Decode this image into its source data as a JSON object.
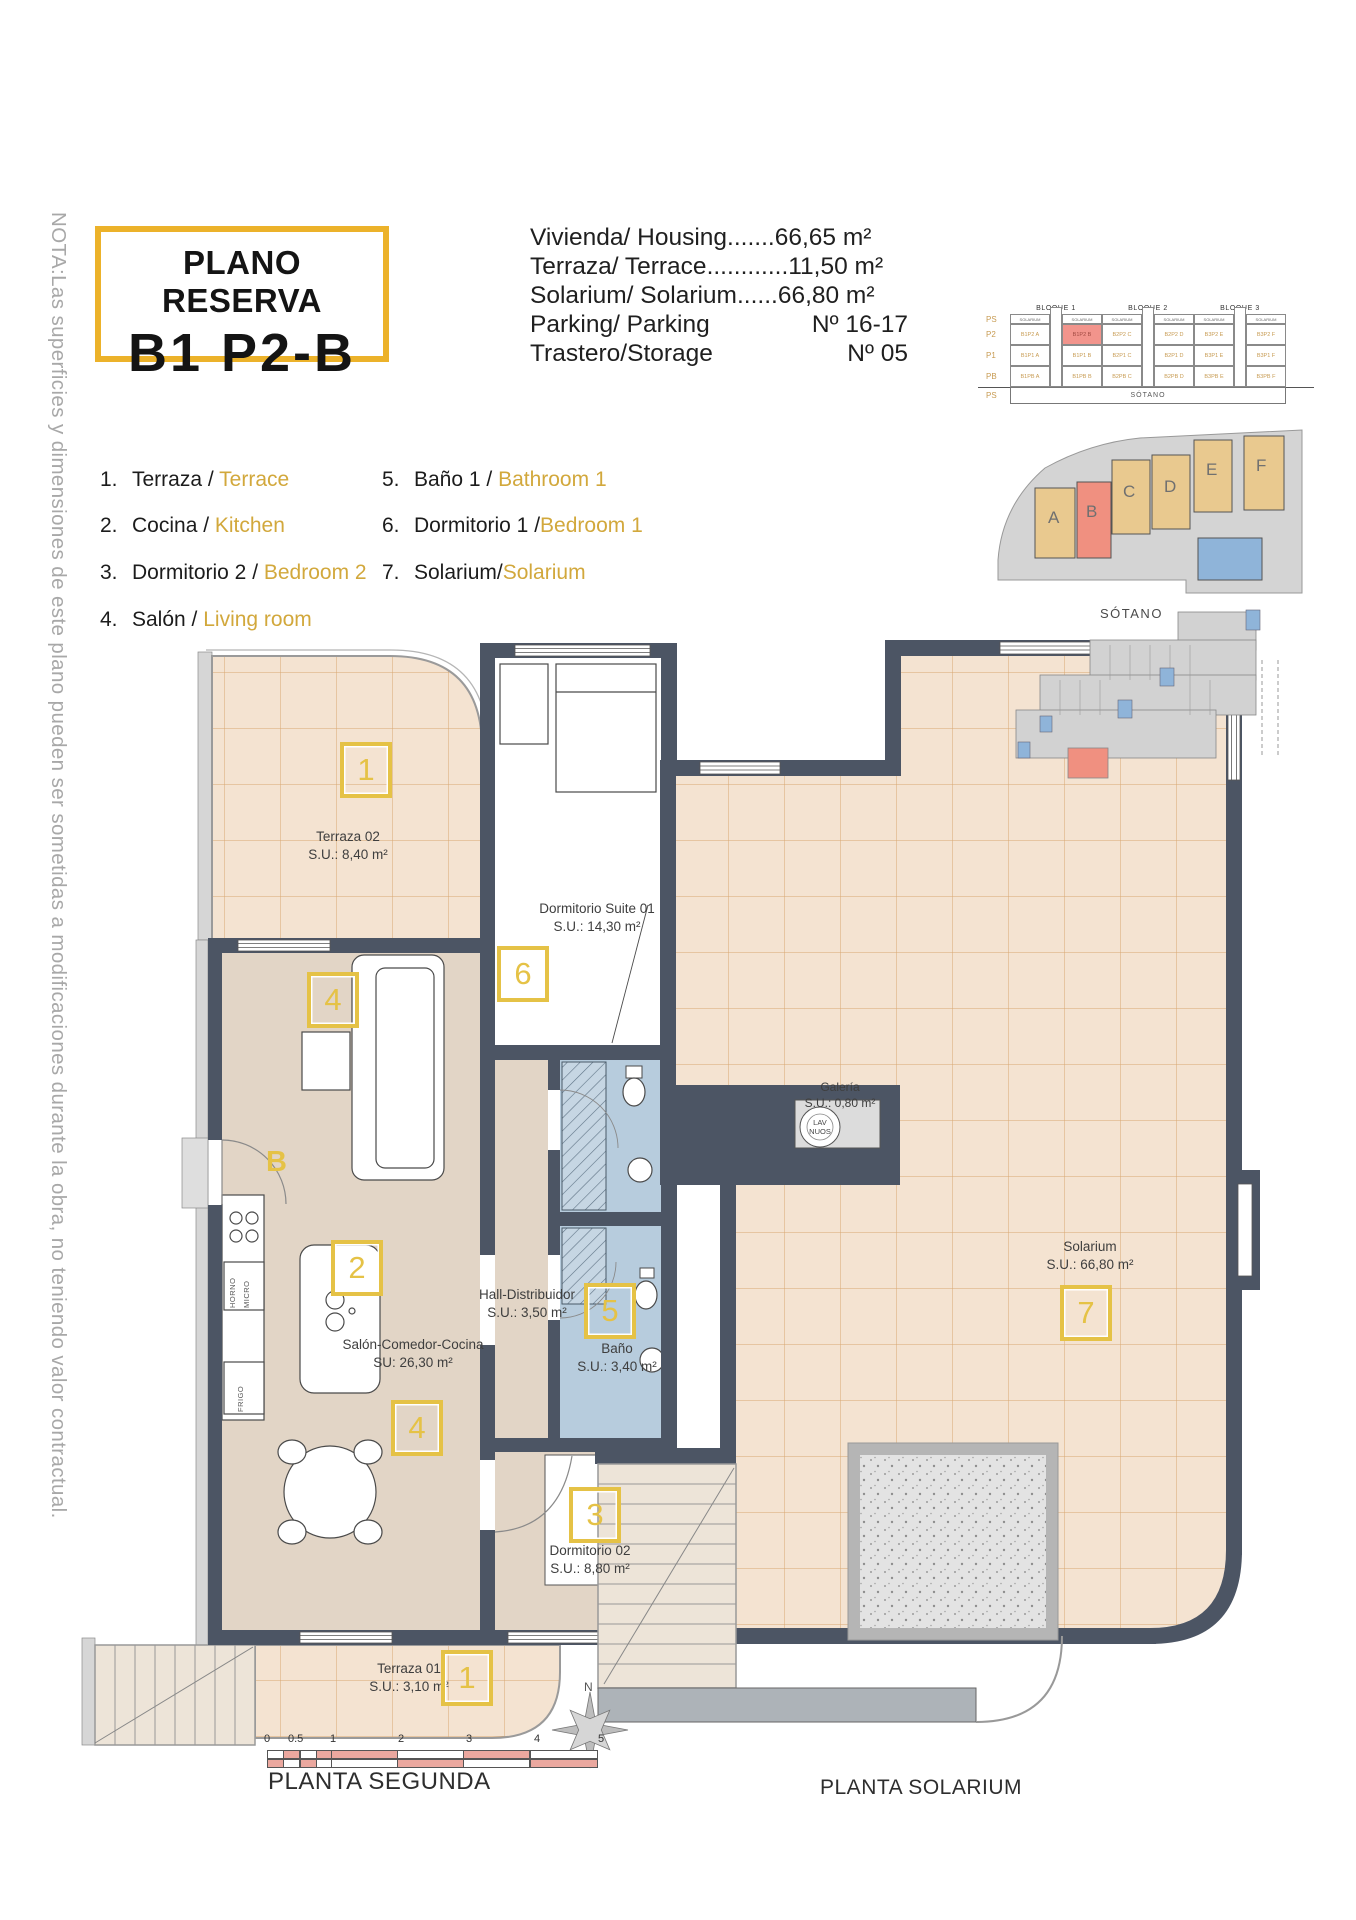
{
  "note": "NOTA:Las superficies y dimensiones de este plano pueden ser sometidas a modificaciones durante la obra, no teniendo valor contractual.",
  "title": {
    "line1": "PLANO RESERVA",
    "line2": "B1 P2-B"
  },
  "summary": {
    "rows": [
      {
        "label": "Vivienda/ Housing",
        "dots": ".......",
        "value": "66,65 m²"
      },
      {
        "label": "Terraza/ Terrace",
        "dots": "............",
        "value": "11,50 m²"
      },
      {
        "label": "Solarium/ Solarium",
        "dots": "......",
        "value": "66,80 m²"
      },
      {
        "label": "Parking/ Parking",
        "dots": "",
        "value": "Nº 16-17"
      },
      {
        "label": "Trastero/Storage",
        "dots": "",
        "value": "Nº 05"
      }
    ]
  },
  "legend": {
    "col1": [
      {
        "num": "1.",
        "es": "Terraza / ",
        "en": "Terrace"
      },
      {
        "num": "2.",
        "es": "Cocina / ",
        "en": "Kitchen"
      },
      {
        "num": "3.",
        "es": "Dormitorio 2 / ",
        "en": "Bedroom 2"
      },
      {
        "num": "4.",
        "es": "Salón / ",
        "en": "Living room"
      }
    ],
    "col2": [
      {
        "num": "5.",
        "es": "Baño 1 / ",
        "en": "Bathroom 1"
      },
      {
        "num": "6.",
        "es": "Dormitorio 1 /",
        "en": "Bedroom 1"
      },
      {
        "num": "7.",
        "es": "Solarium/",
        "en": "Solarium"
      }
    ]
  },
  "blocks": {
    "titles": [
      "BLOQUE 1",
      "BLOQUE 2",
      "BLOQUE 3"
    ],
    "header": "SOLARIUM",
    "row_labels": [
      "PS",
      "P2",
      "P1",
      "PB",
      "PS"
    ],
    "rows": [
      {
        "cells": [
          "B1P2 A",
          "B1P2 B",
          "B2P2 C",
          "B2P2 D",
          "B3P2 E",
          "B3P2 F"
        ]
      },
      {
        "cells": [
          "B1P1 A",
          "B1P1 B",
          "B2P1 C",
          "B2P1 D",
          "B3P1 E",
          "B3P1 F"
        ]
      },
      {
        "cells": [
          "B1PB A",
          "B1PB B",
          "B2PB C",
          "B2PB D",
          "B3PB E",
          "B3PB F"
        ]
      }
    ],
    "basement": "SÓTANO"
  },
  "site": {
    "units": [
      "A",
      "B",
      "C",
      "D",
      "E",
      "F"
    ]
  },
  "sotano": {
    "title": "SÓTANO"
  },
  "plan2": {
    "terraza02": {
      "name": "Terraza 02",
      "area": "S.U.: 8,40 m²"
    },
    "suite": {
      "name": "Dormitorio Suite 01",
      "area": "S.U.: 14,30 m²"
    },
    "hall": {
      "name": "Hall-Distribuidor",
      "area": "S.U.: 3,50 m²"
    },
    "salon": {
      "name": "Salón-Comedor-Cocina",
      "area": "SU: 26,30 m²"
    },
    "bano": {
      "name": "Baño",
      "area": "S.U.: 3,40 m²"
    },
    "dorm02": {
      "name": "Dormitorio 02",
      "area": "S.U.: 8,80 m²"
    },
    "terraza01": {
      "name": "Terraza 01",
      "area": "S.U.: 3,10 m²"
    },
    "door_label": "B",
    "appliances": {
      "horno": "HORNO",
      "micro": "MICRO",
      "frigo": "FRIGO"
    }
  },
  "solarium": {
    "galeria": {
      "name": "Galería",
      "area": "S.U.: 0,80 m²",
      "washer_l1": "LAV",
      "washer_l2": "NUOS"
    },
    "main": {
      "name": "Solarium",
      "area": "S.U.: 66,80 m²"
    }
  },
  "markers": {
    "m1": "1",
    "m2": "2",
    "m3": "3",
    "m4": "4",
    "m5": "5",
    "m6": "6",
    "m7": "7"
  },
  "footer": {
    "ticks": [
      "0",
      "0.5",
      "1",
      "2",
      "3",
      "4",
      "5"
    ],
    "caption_plan2": "PLANTA SEGUNDA",
    "caption_solarium": "PLANTA SOLARIUM",
    "north": "N"
  },
  "colors": {
    "accent_yellow": "#ECB22A",
    "legend_gold": "#D2A83C",
    "marker_yellow": "#E5C246",
    "wall_gray": "#4C5564",
    "floor_beige": "#E2D5C6",
    "terrace_peach": "#F4E3D1",
    "terrace_grid": "#D8A771",
    "bath_blue": "#B7CCDD",
    "highlight_salmon": "#F09080",
    "unit_tan": "#E9C98F",
    "site_gray": "#D4D4D4",
    "pool_blue": "#8FB4D9",
    "scale_salmon": "#EBA89F"
  }
}
